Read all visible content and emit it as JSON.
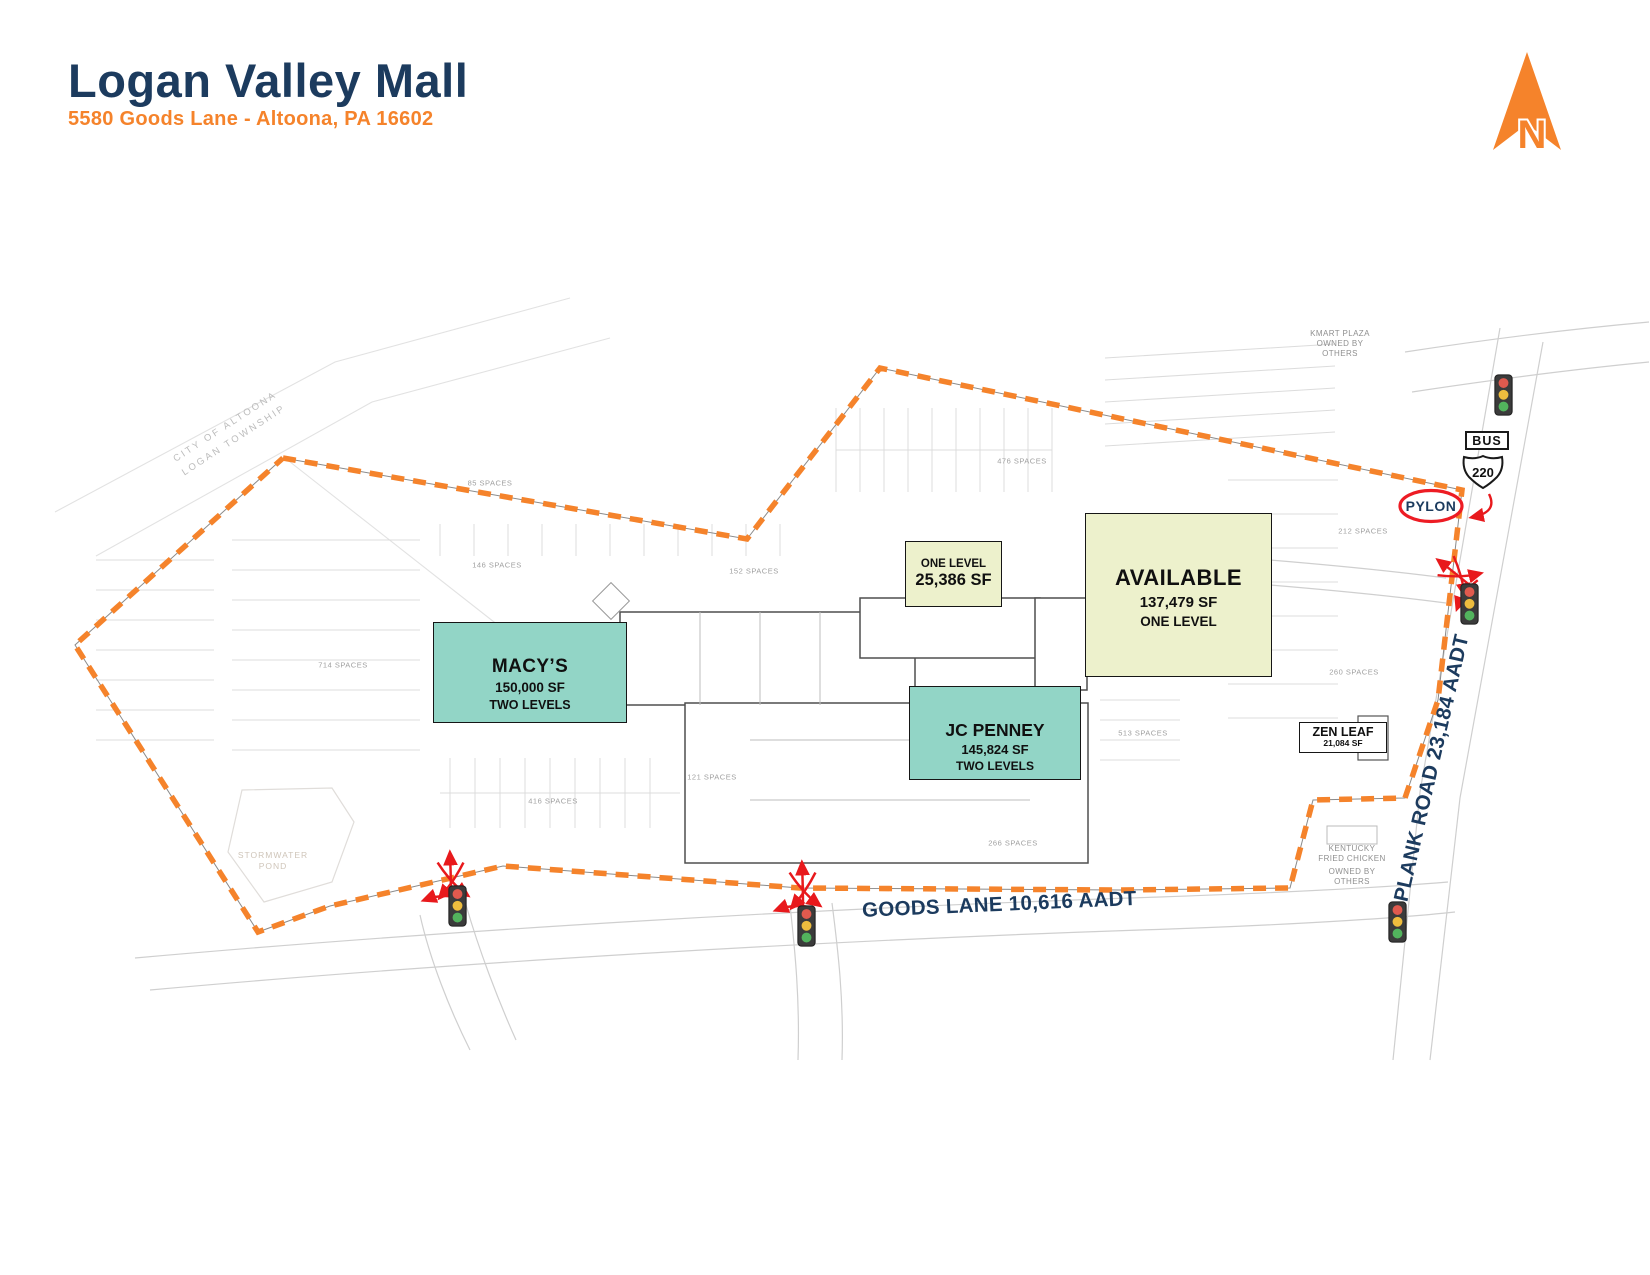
{
  "header": {
    "title": "Logan Valley Mall",
    "subtitle": "5580 Goods Lane - Altoona, PA 16602"
  },
  "north": {
    "letter": "N"
  },
  "colors": {
    "navy": "#1c3b5e",
    "orange": "#f5832b",
    "teal_anchor": "#92d5c6",
    "pale_yellow_anchor": "#edf1cc",
    "red_accent": "#e8191c"
  },
  "map": {
    "anchors": {
      "macys": {
        "name": "MACY’S",
        "sf": "150,000 SF",
        "levels": "TWO LEVELS"
      },
      "jcpenney": {
        "name": "JC PENNEY",
        "sf": "145,824 SF",
        "levels": "TWO LEVELS"
      },
      "one_level": {
        "name": "ONE LEVEL",
        "sf": "25,386 SF"
      },
      "available": {
        "name": "AVAILABLE",
        "sf": "137,479 SF",
        "levels": "ONE LEVEL"
      },
      "zen_leaf": {
        "name": "ZEN LEAF",
        "sf": "21,084 SF"
      }
    },
    "roads": {
      "goods_lane": "GOODS LANE 10,616 AADT",
      "plank_road": "PLANK ROAD 23,184 AADT"
    },
    "signs": {
      "bus": "BUS",
      "route": "220",
      "pylon": "PYLON"
    },
    "parcels": {
      "kmart": {
        "l1": "KMART PLAZA",
        "l2": "OWNED BY",
        "l3": "OTHERS"
      },
      "kfc": {
        "l1": "KENTUCKY",
        "l2": "FRIED CHICKEN",
        "l3": "OWNED BY",
        "l4": "OTHERS"
      }
    },
    "areas": {
      "stormwater": {
        "l1": "STORMWATER",
        "l2": "POND"
      },
      "municipal": {
        "l1": "CITY  OF  ALTOONA",
        "l2": "LOGAN  TOWNSHIP"
      }
    },
    "parking_labels": [
      "85 SPACES",
      "146 SPACES",
      "152 SPACES",
      "714 SPACES",
      "476 SPACES",
      "212 SPACES",
      "260 SPACES",
      "513 SPACES",
      "121 SPACES",
      "266 SPACES",
      "416 SPACES"
    ]
  }
}
